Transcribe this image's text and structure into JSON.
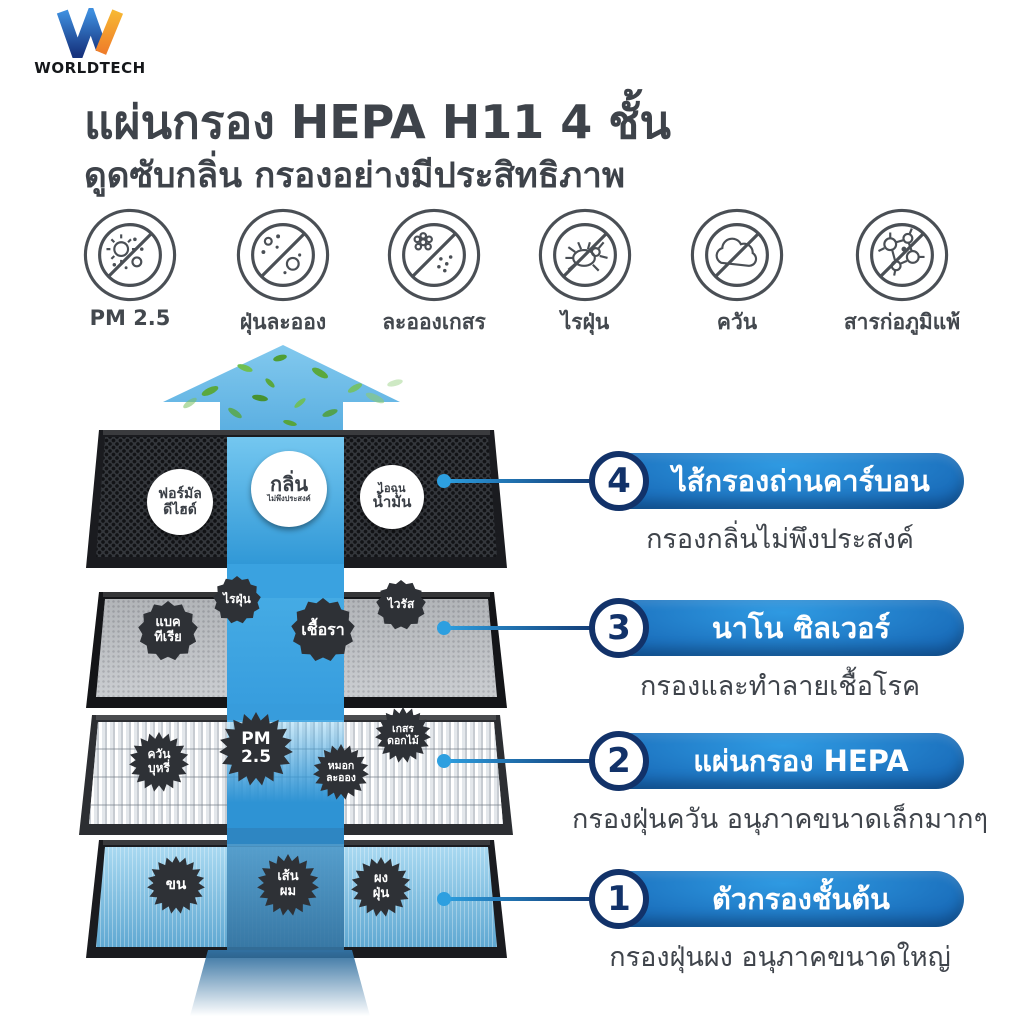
{
  "brand": {
    "name": "WORLDTECH"
  },
  "header": {
    "title": "แผ่นกรอง HEPA H11 4 ชั้น",
    "subtitle": "ดูดซับกลิ่น กรองอย่างมีประสิทธิภาพ"
  },
  "blocked_particles": [
    {
      "icon": "pm25-icon",
      "label": "PM 2.5"
    },
    {
      "icon": "dust-icon",
      "label": "ฝุ่นละออง"
    },
    {
      "icon": "pollen-icon",
      "label": "ละอองเกสร"
    },
    {
      "icon": "dust-mite-icon",
      "label": "ไรฝุ่น"
    },
    {
      "icon": "smoke-icon",
      "label": "ควัน"
    },
    {
      "icon": "allergen-icon",
      "label": "สารก่อภูมิแพ้"
    }
  ],
  "layers": [
    {
      "number": "4",
      "name": "ไส้กรองถ่านคาร์บอน",
      "description": "กรองกลิ่นไม่พึงประสงค์",
      "material": "black-carbon-honeycomb",
      "bubbles": [
        {
          "id": "formaldehyde",
          "lines": [
            "ฟอร์มัล",
            "ดีไฮด์"
          ]
        },
        {
          "id": "odor",
          "lines": [
            "กลิ่น",
            "ไม่พึงประสงค์"
          ]
        },
        {
          "id": "oil-fume",
          "lines": [
            "ไอฉุน",
            "น้ำมัน"
          ]
        }
      ]
    },
    {
      "number": "3",
      "name": "นาโน ซิลเวอร์",
      "description": "กรองและทำลายเชื้อโรค",
      "material": "gray-nano-silver-mesh",
      "bubbles": [
        {
          "id": "bacteria",
          "lines": [
            "แบค",
            "ทีเรีย"
          ]
        },
        {
          "id": "dust-mite",
          "lines": [
            "ไรฝุ่น"
          ]
        },
        {
          "id": "fungus",
          "lines": [
            "เชื้อรา"
          ]
        },
        {
          "id": "virus",
          "lines": [
            "ไวรัส"
          ]
        }
      ]
    },
    {
      "number": "2",
      "name": "แผ่นกรอง HEPA",
      "description": "กรองฝุ่นควัน อนุภาคขนาดเล็กมากๆ",
      "material": "white-pleated-hepa",
      "bubbles": [
        {
          "id": "cigarette-smoke",
          "lines": [
            "ควัน",
            "บุหรี่"
          ]
        },
        {
          "id": "pm25",
          "lines": [
            "PM",
            "2.5"
          ]
        },
        {
          "id": "mist",
          "lines": [
            "หมอก",
            "ละออง"
          ]
        },
        {
          "id": "flower-pollen",
          "lines": [
            "เกสร",
            "ดอกไม้"
          ]
        }
      ]
    },
    {
      "number": "1",
      "name": "ตัวกรองชั้นต้น",
      "description": "กรองฝุ่นผง อนุภาคขนาดใหญ่",
      "material": "blue-pre-filter",
      "bubbles": [
        {
          "id": "fur",
          "lines": [
            "ขน"
          ]
        },
        {
          "id": "hair",
          "lines": [
            "เส้น",
            "ผม"
          ]
        },
        {
          "id": "dust-powder",
          "lines": [
            "ผง",
            "ฝุ่น"
          ]
        }
      ]
    }
  ],
  "colors": {
    "accent_blue": "#2d9fe0",
    "navy": "#123269",
    "pill_gradient_start": "#2f9ae2",
    "pill_gradient_end": "#0a2e66",
    "stream_blue": "#3aa2e0",
    "arrow_blue": "#6fbde9",
    "leaf_green": "#5aa83e",
    "title_text": "#3e434a"
  }
}
